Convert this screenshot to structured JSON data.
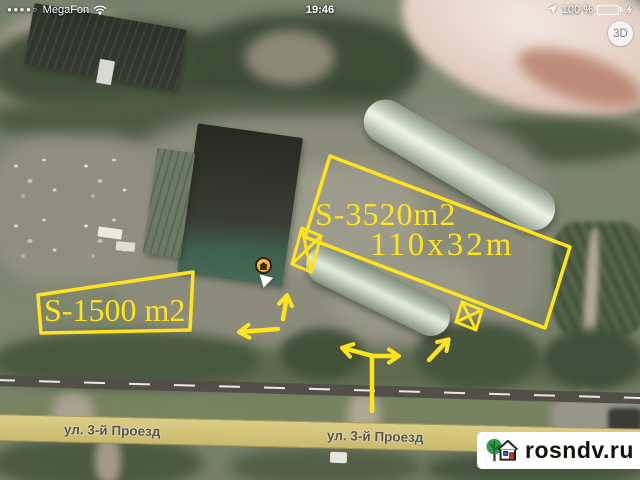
{
  "status_bar": {
    "signal_dots": "●●●●○",
    "carrier": "MegaFon",
    "time": "19:46",
    "battery_percent": "100 %",
    "battery_color": "#53d769"
  },
  "map": {
    "mode_button_label": "3D",
    "street_label_left": "ул. 3-й Проезд",
    "street_label_center": "ул. 3-й Проезд"
  },
  "annotations": {
    "color": "#ffe41c",
    "large_area_label": "S-3520m2",
    "large_area_dimensions": "110x32m",
    "small_area_label": "S-1500 m2"
  },
  "watermark": {
    "site": "rosndv.ru",
    "logo_tree_color": "#2f9e4f",
    "logo_door_color": "#d6382e",
    "logo_window_color": "#3b6fd4"
  }
}
